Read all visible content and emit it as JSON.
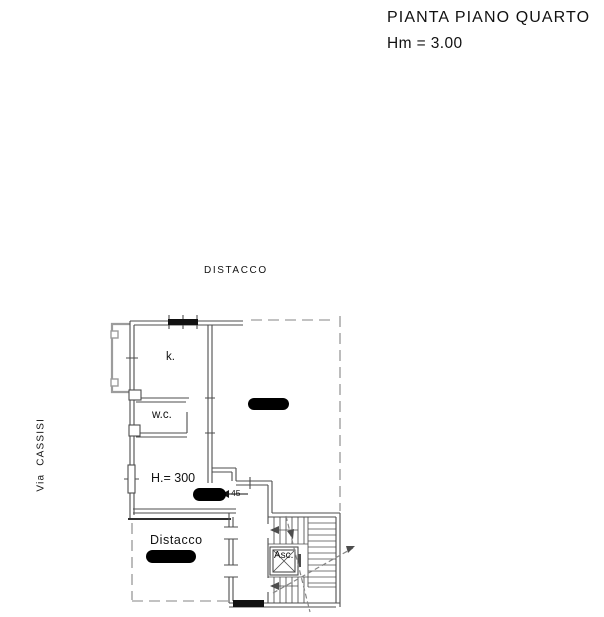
{
  "header": {
    "title": "PIANTA PIANO QUARTO",
    "height_note": "Hm = 3.00"
  },
  "plan": {
    "setback_label_top": "DISTACCO",
    "street_label": "Via  CASSISI",
    "room_labels": {
      "kitchen": "k.",
      "wc": "w.c.",
      "ceiling_height": "H.= 300",
      "setback": "Distacco",
      "elevator": "Asc."
    },
    "annotations": {
      "door_width": "45"
    }
  },
  "colors": {
    "ink": "#111111",
    "wall": "#4d4d4d",
    "dashed": "#858585",
    "balcony": "#9c9c9c",
    "redaction": "#000000"
  }
}
